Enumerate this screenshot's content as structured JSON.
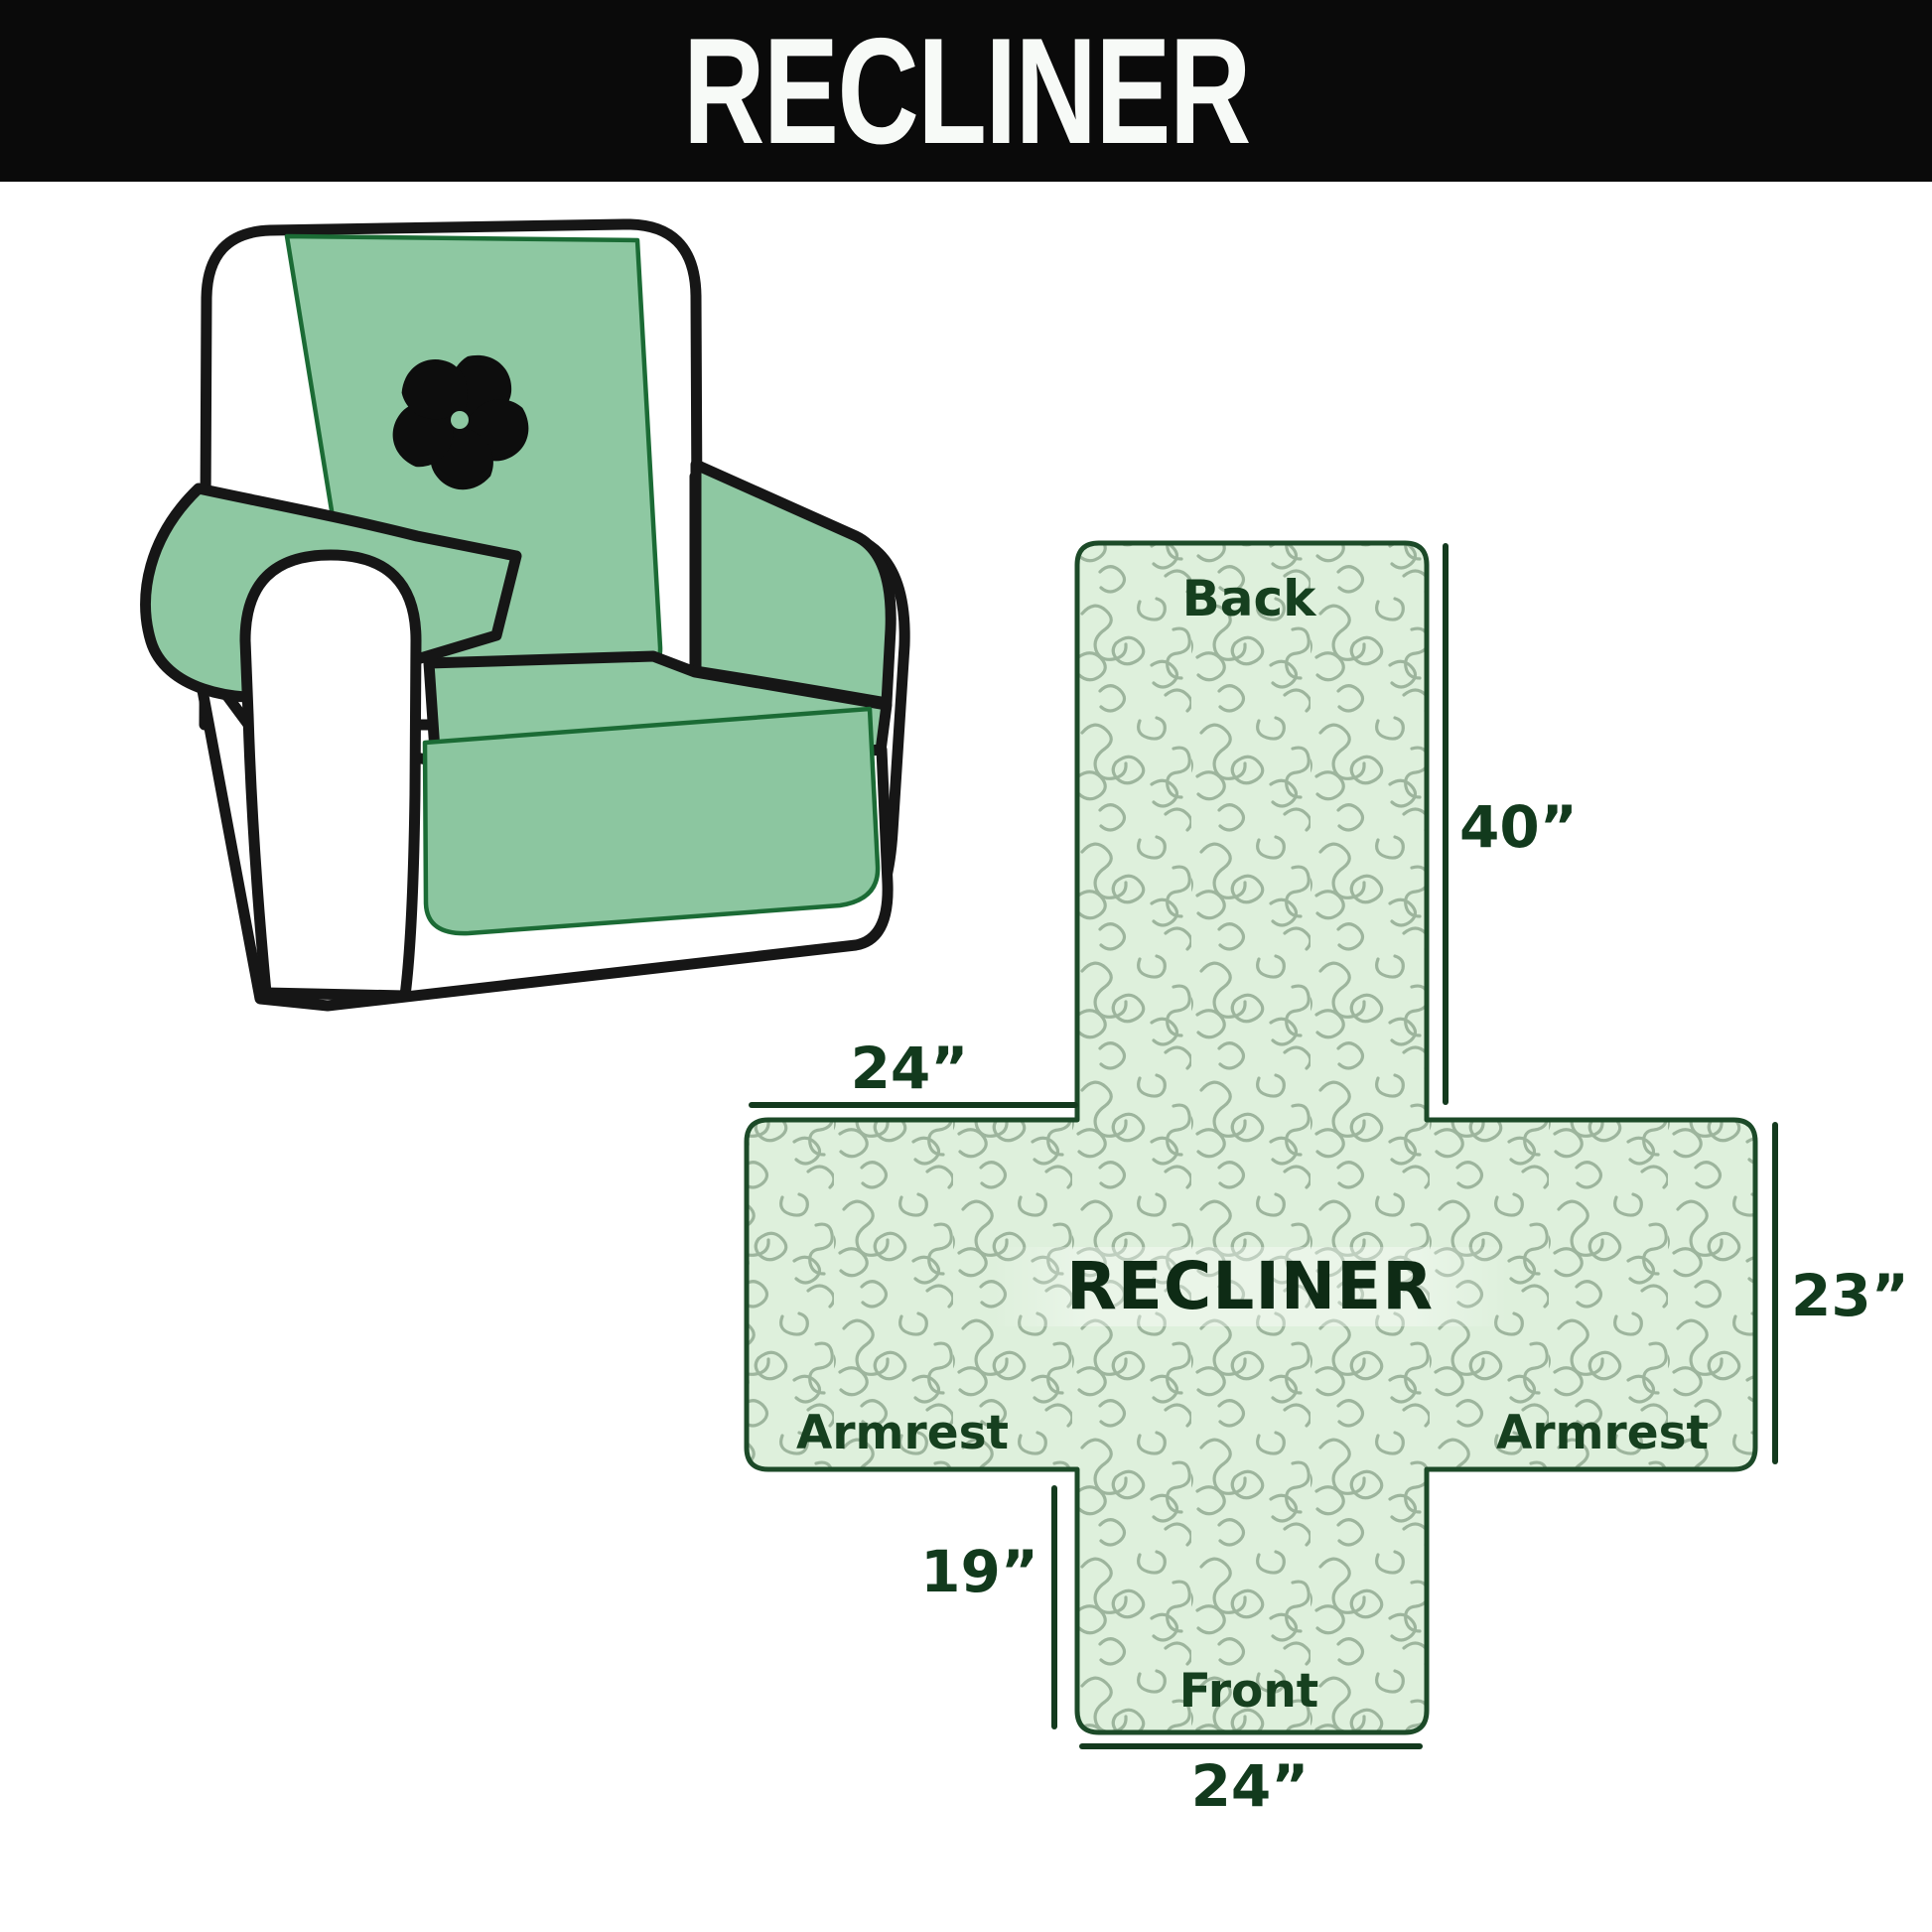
{
  "header": {
    "title": "RECLINER"
  },
  "diagram": {
    "center_label": "RECLINER",
    "back_label": "Back",
    "front_label": "Front",
    "armrest_left_label": "Armrest",
    "armrest_right_label": "Armrest",
    "dim_back_height": "40”",
    "dim_top_width": "24”",
    "dim_side_height": "23”",
    "dim_front_drop": "19”",
    "dim_bottom_width": "24”"
  },
  "illustration": {
    "fan_icon": "pinwheel-icon"
  },
  "colors": {
    "header_bg": "#0a0a0a",
    "header_text": "#f7faf7",
    "cover_green": "#8ec8a2",
    "cover_edge_green": "#1b6b35",
    "cross_fill": "#def0dc",
    "pattern_line": "#92aa92",
    "cross_border": "#1c4a28",
    "dim_line": "#143a1e",
    "label_green": "#16401f",
    "center_text": "#0e2b15",
    "chair_outline": "#161616"
  }
}
